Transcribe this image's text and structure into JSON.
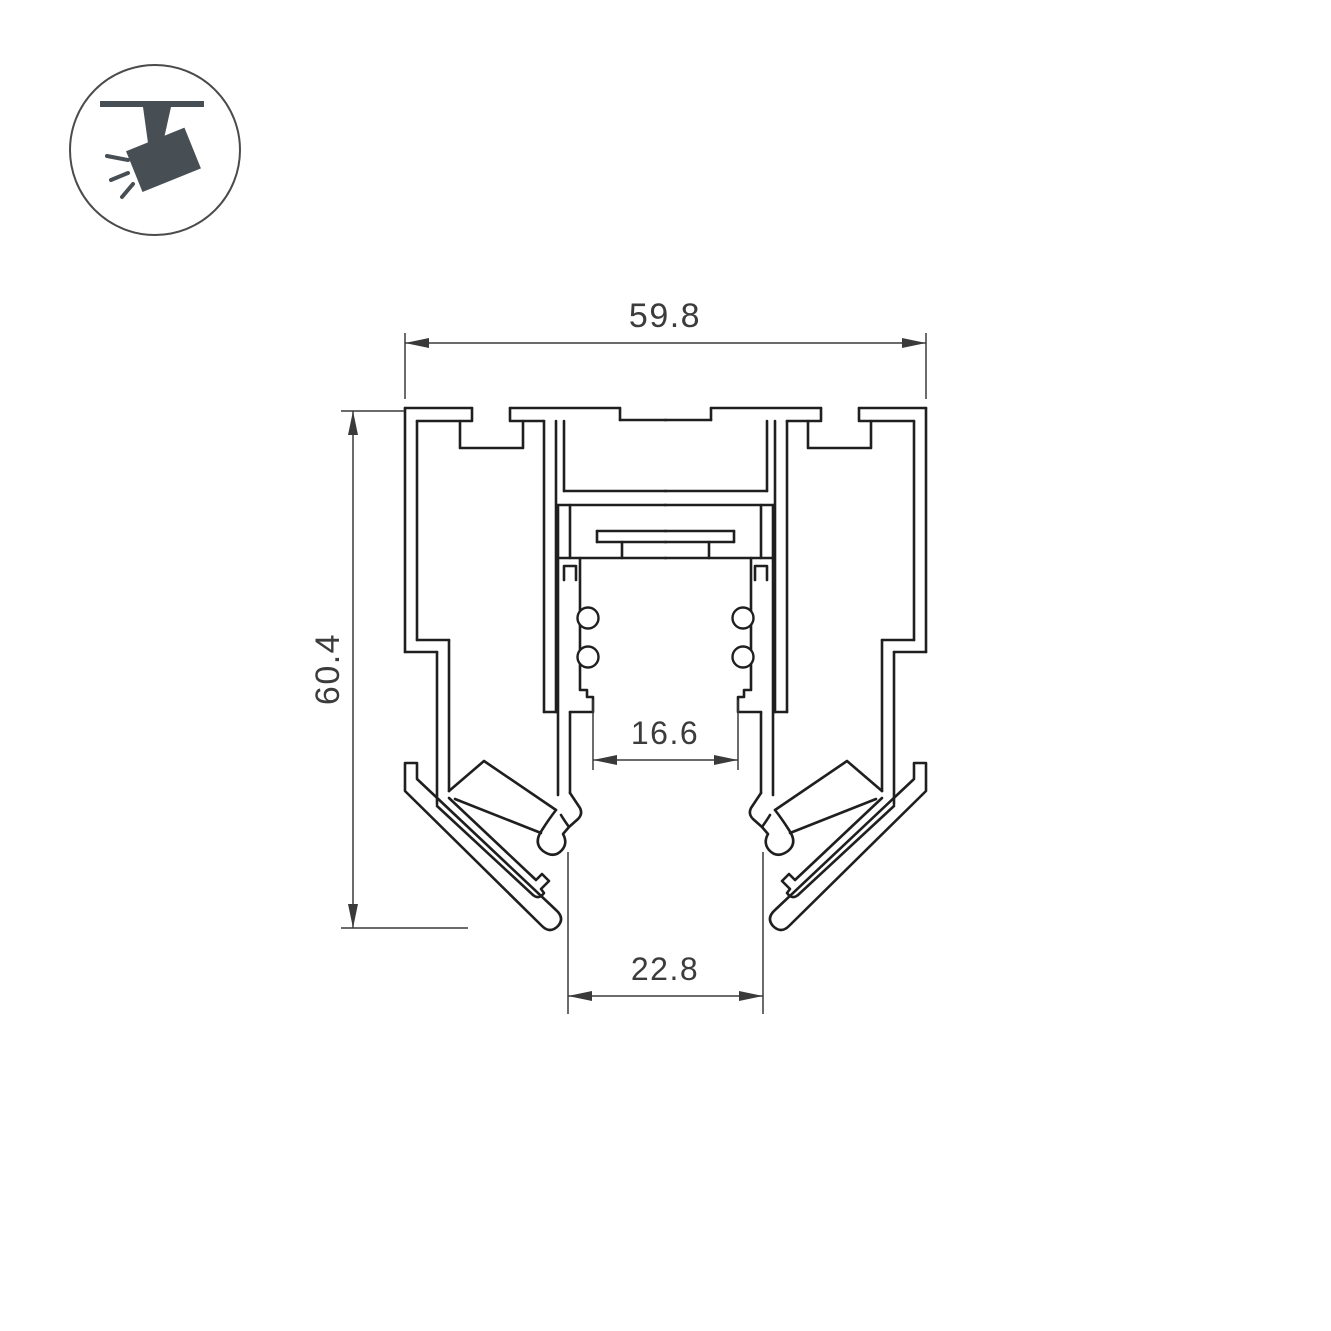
{
  "drawing": {
    "type": "technical-cross-section",
    "subject": "recessed magnetic track lighting profile",
    "background_color": "#ffffff",
    "line_color": "#1f1f1f",
    "dimension_line_color": "#3a3a3a",
    "text_color": "#3c3c3c"
  },
  "icon": {
    "name": "track-spotlight-icon",
    "description": "ceiling track spotlight pictogram in circle",
    "color": "#474e54"
  },
  "dimensions": {
    "overall_width": {
      "value": "59.8",
      "orientation": "horizontal",
      "position": "top"
    },
    "overall_height": {
      "value": "60.4",
      "orientation": "vertical",
      "position": "left"
    },
    "track_opening": {
      "value": "16.6",
      "orientation": "horizontal",
      "position": "middle"
    },
    "bottom_opening": {
      "value": "22.8",
      "orientation": "horizontal",
      "position": "bottom"
    }
  }
}
